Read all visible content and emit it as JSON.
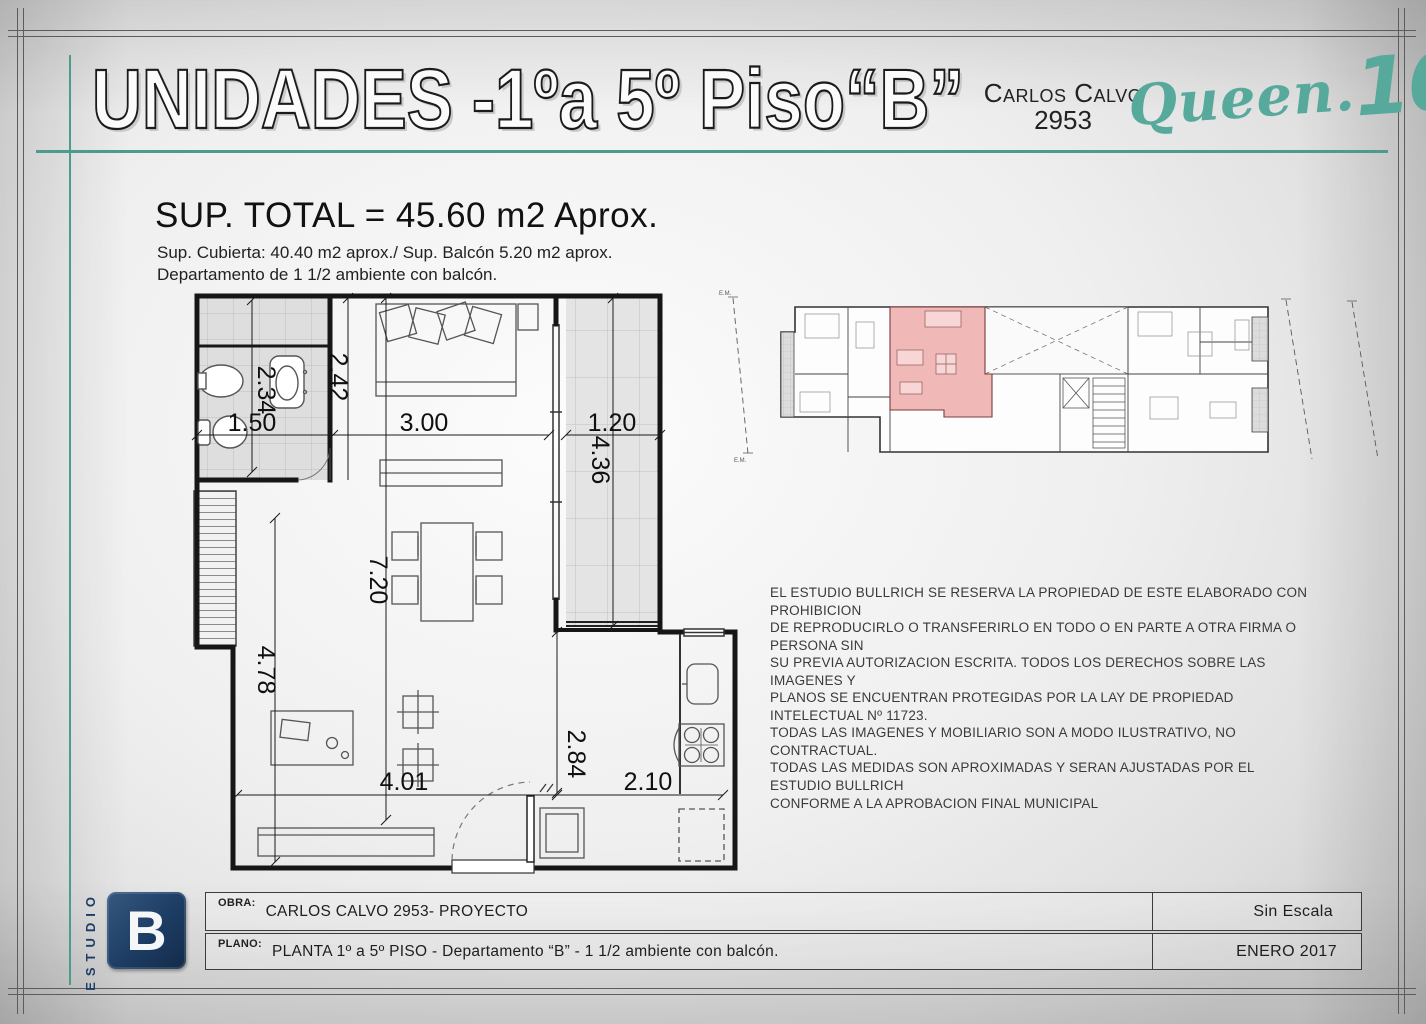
{
  "page": {
    "title": "UNIDADES -1ºa 5º Piso“B”",
    "address_name": "Carlos Calvo",
    "address_number": "2953",
    "brand_script": "Queen.",
    "brand_number": "10",
    "accent_color": "#4e9a8c",
    "navy_color": "#1d3c63",
    "unit_highlight_color": "#f0b9b8"
  },
  "summary": {
    "total": "SUP. TOTAL = 45.60 m2 Aprox.",
    "detail": "Sup. Cubierta: 40.40 m2 aprox./ Sup. Balcón 5.20 m2 aprox.",
    "description": "Departamento de 1 1/2 ambiente con balcón."
  },
  "plan": {
    "dims": {
      "bath_height": "2.34",
      "bath_width": "1.50",
      "bed_left": "2.42",
      "bed_width": "3.00",
      "balcony_width": "1.20",
      "balcony_height": "4.36",
      "living_height": "7.20",
      "lower_left_height": "4.78",
      "living_width": "4.01",
      "kitchen_height": "2.84",
      "kitchen_width": "2.10"
    }
  },
  "overview": {
    "marker": "E.M."
  },
  "legal": "EL ESTUDIO BULLRICH SE RESERVA LA PROPIEDAD DE ESTE ELABORADO CON PROHIBICION\nDE REPRODUCIRLO O TRANSFERIRLO EN TODO O EN PARTE A OTRA FIRMA O PERSONA SIN\nSU PREVIA AUTORIZACION ESCRITA. TODOS LOS DERECHOS SOBRE LAS IMAGENES Y\nPLANOS SE ENCUENTRAN PROTEGIDAS POR LA LAY DE PROPIEDAD INTELECTUAL Nº 11723.\nTODAS LAS IMAGENES Y MOBILIARIO SON A MODO ILUSTRATIVO, NO CONTRACTUAL.\nTODAS LAS MEDIDAS SON APROXIMADAS Y SERAN AJUSTADAS POR EL ESTUDIO BULLRICH\nCONFORME A LA APROBACION FINAL MUNICIPAL",
  "titleblock": {
    "studio_vertical": "ESTUDIO",
    "logo_letter": "B",
    "obra_label": "OBRA:",
    "obra_value": "CARLOS CALVO 2953- PROYECTO",
    "plano_label": "PLANO:",
    "plano_value": "PLANTA  1º a 5º PISO - Departamento “B” - 1 1/2 ambiente con balcón.",
    "scale": "Sin Escala",
    "date": "ENERO 2017"
  }
}
